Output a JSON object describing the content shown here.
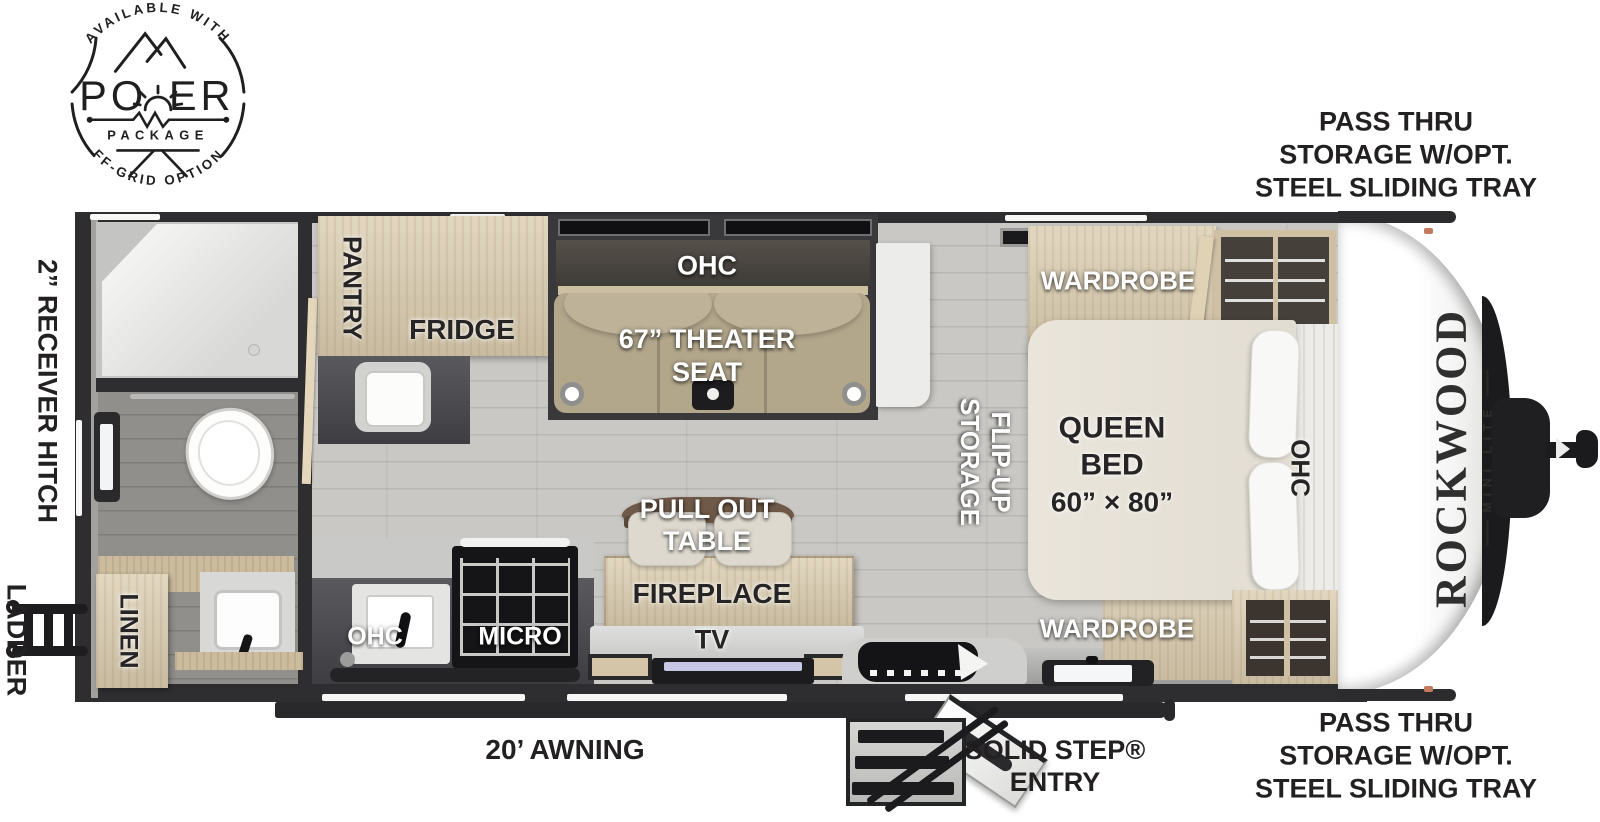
{
  "badge": {
    "arc_top": "AVAILABLE WITH",
    "power_left": "PO",
    "power_right": "ER",
    "package": "PACKAGE",
    "arc_bottom": "OFF-GRID OPTIONS"
  },
  "exterior": {
    "receiver_hitch": "2” RECEIVER HITCH",
    "ladder": "LADDER",
    "awning": "20’ AWNING",
    "entry_line1": "SOLID STEP®",
    "entry_line2": "ENTRY",
    "pass_thru": {
      "line1": "PASS THRU",
      "line2": "STORAGE W/OPT.",
      "line3": "STEEL SLIDING TRAY"
    }
  },
  "brand": {
    "name": "ROCKWOOD",
    "sub": "MINI LITE"
  },
  "rooms": {
    "pantry": "PANTRY",
    "fridge": "FRIDGE",
    "theater_ohc": "OHC",
    "theater_line1": "67” THEATER",
    "theater_line2": "SEAT",
    "wardrobe_top": "WARDROBE",
    "flip_up_line1": "FLIP-UP",
    "flip_up_line2": "STORAGE",
    "bed_line1": "QUEEN",
    "bed_line2": "BED",
    "bed_line3": "60” × 80”",
    "bed_ohc": "OHC",
    "table_line1": "PULL OUT",
    "table_line2": "TABLE",
    "fireplace": "FIREPLACE",
    "tv": "TV",
    "linen": "LINEN",
    "kitchen_ohc": "OHC",
    "micro": "MICRO",
    "wardrobe_bottom": "WARDROBE"
  }
}
